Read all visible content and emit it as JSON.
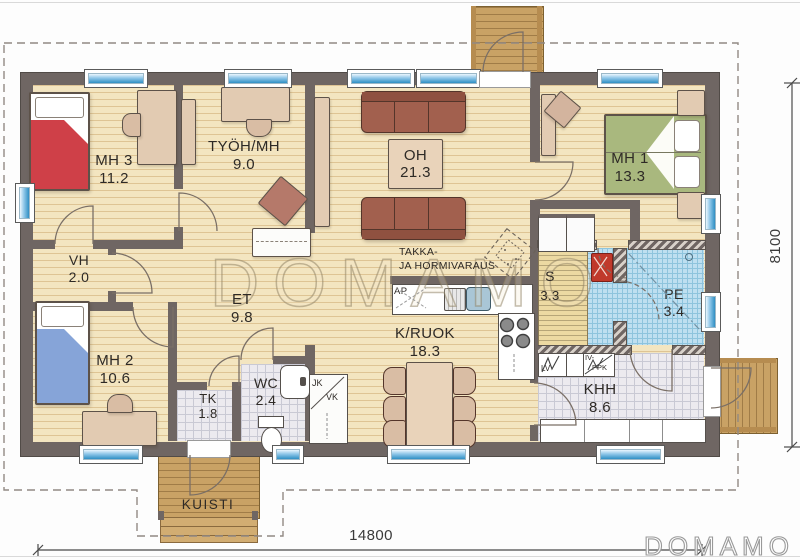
{
  "rooms": {
    "mh3": {
      "name": "MH 3",
      "area": "11.2"
    },
    "tyoh": {
      "name": "TYÖH/MH",
      "area": "9.0"
    },
    "oh": {
      "name": "OH",
      "area": "21.3"
    },
    "mh1": {
      "name": "MH 1",
      "area": "13.3"
    },
    "vh": {
      "name": "VH",
      "area": "2.0"
    },
    "et": {
      "name": "ET",
      "area": "9.8"
    },
    "kruok": {
      "name": "K/RUOK",
      "area": "18.3"
    },
    "mh2": {
      "name": "MH 2",
      "area": "10.6"
    },
    "tk": {
      "name": "TK",
      "area": "1.8"
    },
    "wc": {
      "name": "WC",
      "area": "2.4"
    },
    "sauna": {
      "name": "S",
      "area": "3.3"
    },
    "pe": {
      "name": "PE",
      "area": "3.4"
    },
    "khh": {
      "name": "KHH",
      "area": "8.6"
    },
    "kuisti": {
      "name": "KUISTI"
    }
  },
  "annotations": {
    "fireplace_line1": "TAKKA-",
    "fireplace_line2": "JA HORMIVARAUS",
    "dishwasher": "AP",
    "fridge": "JK",
    "freezer": "VK",
    "water_heater": "LV",
    "ventilation": "IV-",
    "washing_machine": "PPK"
  },
  "dimensions": {
    "overall_width_mm": "14800",
    "overall_height_mm": "8100"
  },
  "watermark": {
    "center": "DOMAMO",
    "corner": "DOMAMO"
  },
  "colors": {
    "wall": "#6f6663",
    "floor_wood": "#f3e5c0",
    "tile_gray": "#eceaef",
    "tile_blue": "#bedff0",
    "window_accent": "#2f8fc4",
    "bed_red": "#cf4048",
    "bed_blue": "#86a4d8",
    "bed_green": "#a9b87e",
    "sofa_brown": "#a2604e",
    "deck_wood": "#c9a265"
  }
}
